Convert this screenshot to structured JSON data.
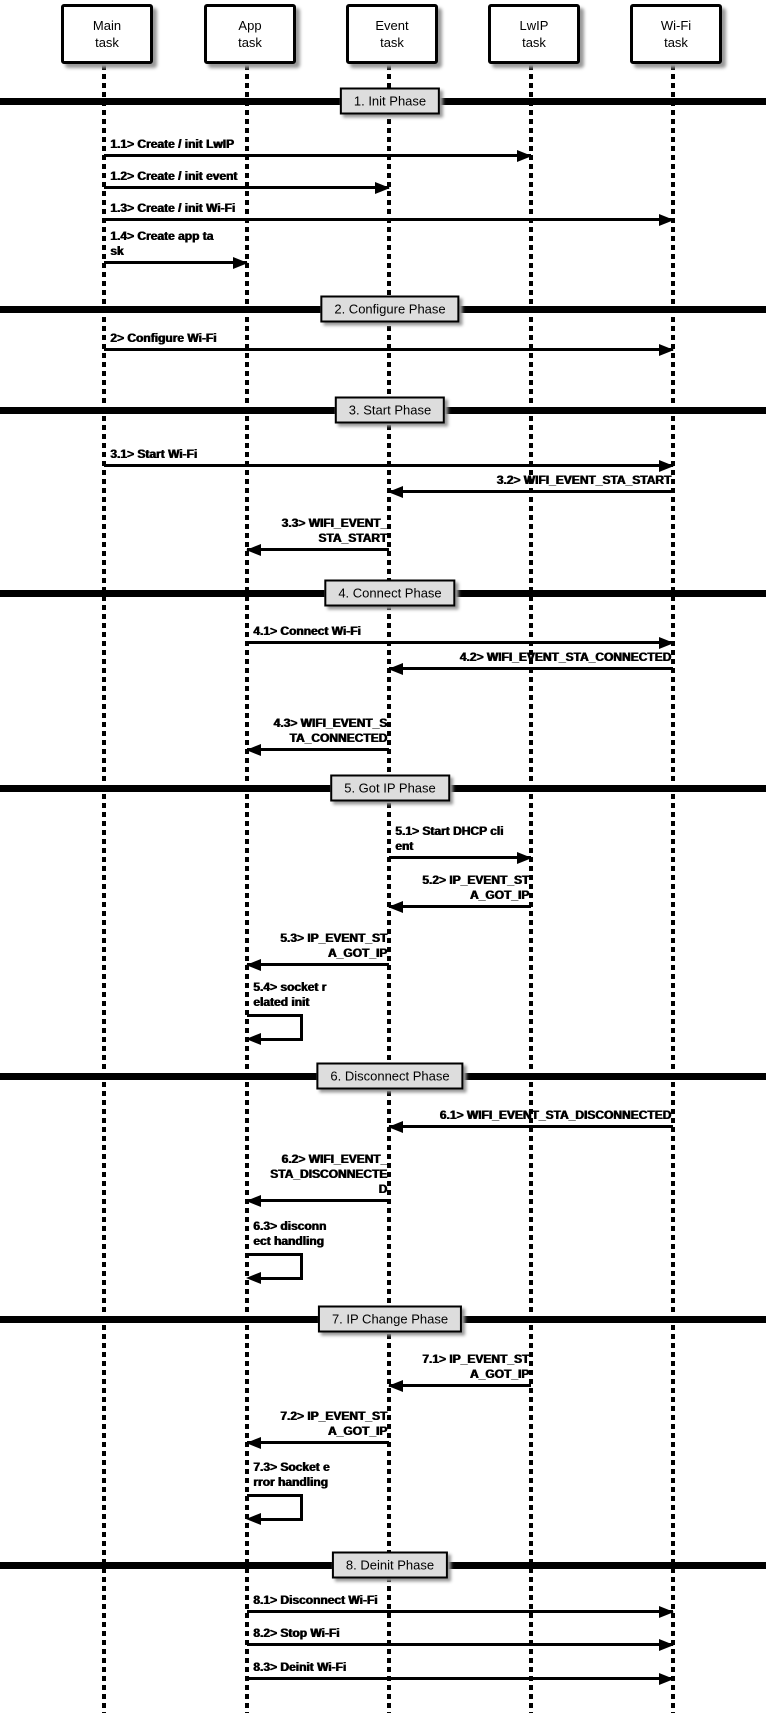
{
  "participants": [
    {
      "line1": "Main",
      "line2": "task"
    },
    {
      "line1": "App",
      "line2": "task"
    },
    {
      "line1": "Event",
      "line2": "task"
    },
    {
      "line1": "LwIP",
      "line2": "task"
    },
    {
      "line1": "Wi-Fi",
      "line2": "task"
    }
  ],
  "phases": [
    {
      "label": "1. Init Phase"
    },
    {
      "label": "2. Configure Phase"
    },
    {
      "label": "3. Start Phase"
    },
    {
      "label": "4. Connect Phase"
    },
    {
      "label": "5. Got IP Phase"
    },
    {
      "label": "6. Disconnect Phase"
    },
    {
      "label": "7. IP Change Phase"
    },
    {
      "label": "8. Deinit Phase"
    }
  ],
  "messages": [
    {
      "num": "1.1",
      "from": "Main task",
      "to": "LwIP task",
      "kind": "arrow",
      "lines": [
        "1.1> Create / init LwIP"
      ]
    },
    {
      "num": "1.2",
      "from": "Main task",
      "to": "Event task",
      "kind": "arrow",
      "lines": [
        "1.2> Create / init event"
      ]
    },
    {
      "num": "1.3",
      "from": "Main task",
      "to": "Wi-Fi task",
      "kind": "arrow",
      "lines": [
        "1.3> Create / init Wi-Fi"
      ]
    },
    {
      "num": "1.4",
      "from": "Main task",
      "to": "App task",
      "kind": "arrow",
      "lines": [
        "1.4> Create app ta",
        "sk"
      ]
    },
    {
      "num": "2",
      "from": "Main task",
      "to": "Wi-Fi task",
      "kind": "arrow",
      "lines": [
        "2> Configure Wi-Fi"
      ]
    },
    {
      "num": "3.1",
      "from": "Main task",
      "to": "Wi-Fi task",
      "kind": "arrow",
      "lines": [
        "3.1> Start Wi-Fi"
      ]
    },
    {
      "num": "3.2",
      "from": "Wi-Fi task",
      "to": "Event task",
      "kind": "arrow",
      "lines": [
        "3.2> WIFI_EVENT_STA_START"
      ]
    },
    {
      "num": "3.3",
      "from": "Event task",
      "to": "App task",
      "kind": "arrow",
      "lines": [
        "3.3> WIFI_EVENT_",
        "STA_START"
      ]
    },
    {
      "num": "4.1",
      "from": "App task",
      "to": "Wi-Fi task",
      "kind": "arrow",
      "lines": [
        "4.1> Connect Wi-Fi"
      ]
    },
    {
      "num": "4.2",
      "from": "Wi-Fi task",
      "to": "Event task",
      "kind": "arrow",
      "lines": [
        "4.2> WIFI_EVENT_STA_CONNECTED"
      ]
    },
    {
      "num": "4.3",
      "from": "Event task",
      "to": "App task",
      "kind": "arrow",
      "lines": [
        "4.3> WIFI_EVENT_S",
        "TA_CONNECTED"
      ]
    },
    {
      "num": "5.1",
      "from": "Event task",
      "to": "LwIP task",
      "kind": "arrow",
      "lines": [
        "5.1> Start DHCP cli",
        "ent"
      ]
    },
    {
      "num": "5.2",
      "from": "LwIP task",
      "to": "Event task",
      "kind": "arrow",
      "lines": [
        "5.2> IP_EVENT_ST",
        "A_GOT_IP"
      ]
    },
    {
      "num": "5.3",
      "from": "Event task",
      "to": "App task",
      "kind": "arrow",
      "lines": [
        "5.3> IP_EVENT_ST",
        "A_GOT_IP"
      ]
    },
    {
      "num": "5.4",
      "from": "App task",
      "to": "App task",
      "kind": "self",
      "lines": [
        "5.4> socket r",
        "elated init"
      ]
    },
    {
      "num": "6.1",
      "from": "Wi-Fi task",
      "to": "Event task",
      "kind": "arrow",
      "lines": [
        "6.1> WIFI_EVENT_STA_DISCONNECTED"
      ]
    },
    {
      "num": "6.2",
      "from": "Event task",
      "to": "App task",
      "kind": "arrow",
      "lines": [
        "6.2> WIFI_EVENT_",
        "STA_DISCONNECTE",
        "D"
      ]
    },
    {
      "num": "6.3",
      "from": "App task",
      "to": "App task",
      "kind": "self",
      "lines": [
        "6.3> disconn",
        "ect handling"
      ]
    },
    {
      "num": "7.1",
      "from": "LwIP task",
      "to": "Event task",
      "kind": "arrow",
      "lines": [
        "7.1> IP_EVENT_ST",
        "A_GOT_IP"
      ]
    },
    {
      "num": "7.2",
      "from": "Event task",
      "to": "App task",
      "kind": "arrow",
      "lines": [
        "7.2> IP_EVENT_ST",
        "A_GOT_IP"
      ]
    },
    {
      "num": "7.3",
      "from": "App task",
      "to": "App task",
      "kind": "self",
      "lines": [
        "7.3> Socket e",
        "rror handling"
      ]
    },
    {
      "num": "8.1",
      "from": "App task",
      "to": "Wi-Fi task",
      "kind": "arrow",
      "lines": [
        "8.1> Disconnect Wi-Fi"
      ]
    },
    {
      "num": "8.2",
      "from": "App task",
      "to": "Wi-Fi task",
      "kind": "arrow",
      "lines": [
        "8.2> Stop Wi-Fi"
      ]
    },
    {
      "num": "8.3",
      "from": "App task",
      "to": "Wi-Fi task",
      "kind": "arrow",
      "lines": [
        "8.3> Deinit Wi-Fi"
      ]
    }
  ],
  "colors": {
    "line": "#000000",
    "background": "#ffffff",
    "phase_label_bg": "#dddddd",
    "participant_bg": "#ffffff"
  }
}
